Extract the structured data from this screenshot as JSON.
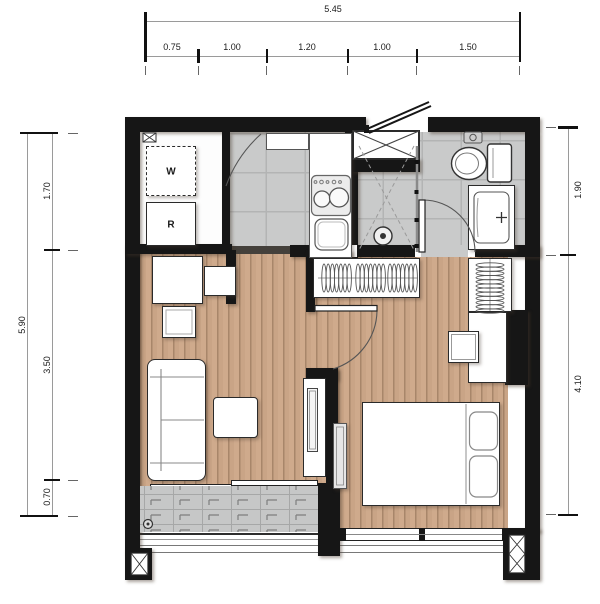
{
  "dimensions": {
    "top": {
      "total": "5.45",
      "segments": [
        "0.75",
        "1.00",
        "1.20",
        "1.00",
        "1.50"
      ]
    },
    "left": {
      "total": "5.90",
      "segments": [
        "1.70",
        "3.50",
        "0.70"
      ]
    },
    "right": {
      "segments": [
        "1.90",
        "4.10"
      ]
    }
  },
  "appliances": {
    "washer": "W",
    "refrigerator": "R"
  },
  "icons": [
    "toilet-icon",
    "vanity-sink-icon",
    "shower-drain-icon",
    "cooktop-icon",
    "kitchen-sink-icon",
    "bed-icon",
    "sofa-icon",
    "wardrobe-hangers-icon",
    "tv-icon",
    "entrance-door-icon",
    "sliding-door-icon",
    "balcony-railing-icon",
    "shaft-icon",
    "column-icon"
  ],
  "colors": {
    "wall": "#161616",
    "wood_floor": "#c9a486",
    "tile_floor": "#c9caca",
    "balcony_floor": "#c6c7c7",
    "dim_text": "#1a1a1a"
  }
}
